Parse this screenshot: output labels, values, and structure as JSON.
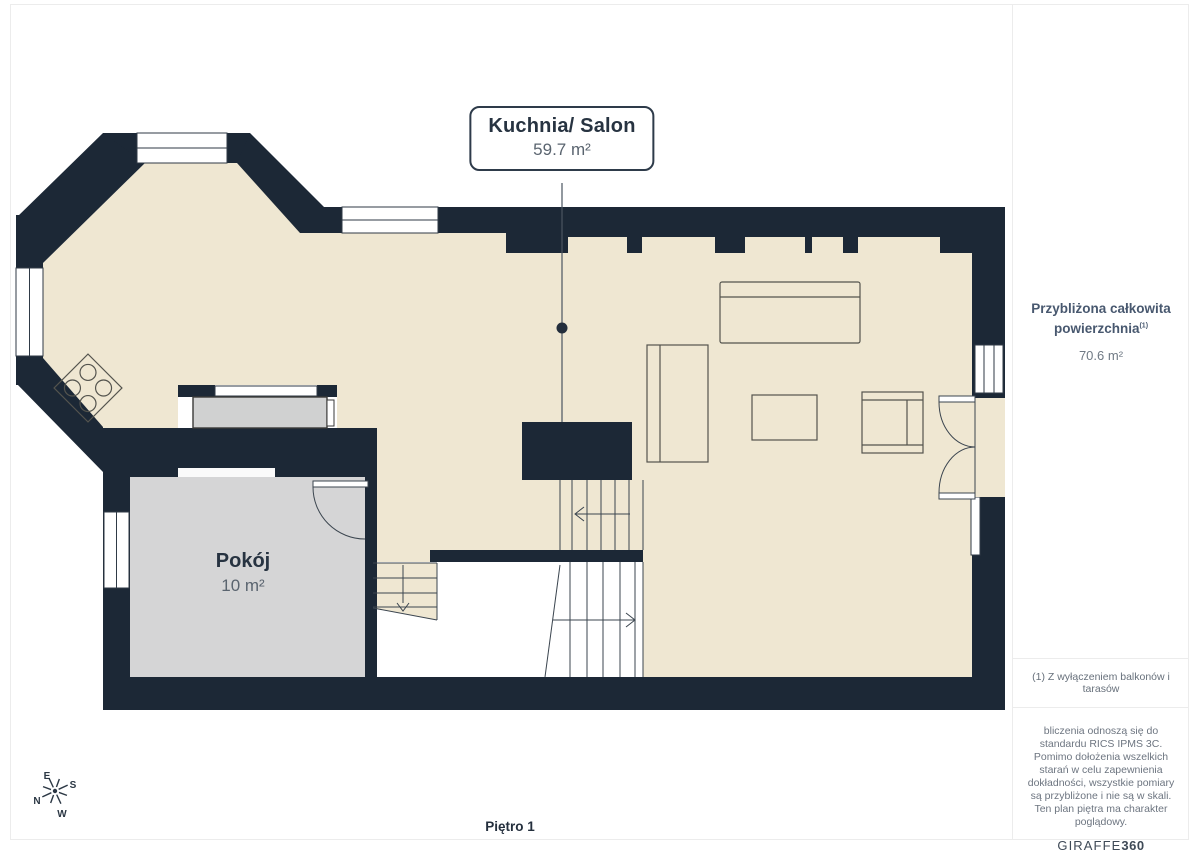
{
  "plan": {
    "floor_label": "Piętro 1",
    "rooms": [
      {
        "name": "Kuchnia/ Salon",
        "area": "59.7 m²"
      },
      {
        "name": "Pokój",
        "area": "10 m²"
      }
    ]
  },
  "sidebar": {
    "total_area_title": "Przybliżona całkowita powierzchnia",
    "total_area_footnote_ref": "(1)",
    "total_area_value": "70.6 m²",
    "footnote": "(1) Z wyłączeniem balkonów i tarasów",
    "disclaimer": "bliczenia odnoszą się do standardu RICS IPMS 3C. Pomimo dołożenia wszelkich starań w celu zapewnienia dokładności, wszystkie pomiary są przybliżone i nie są w skali. Ten plan piętra ma charakter poglądowy.",
    "logo_primary": "GIRAFFE",
    "logo_secondary": "360"
  },
  "compass": {
    "north": "N",
    "east": "E",
    "south": "S",
    "west": "W"
  },
  "colors": {
    "wall": "#1c2836",
    "floor": "#efe7d2",
    "room_gray": "#d5d5d6",
    "counter_gray": "#d0d1d1",
    "accent_text": "#273341",
    "muted_text": "#5a646f",
    "border": "#ececec"
  }
}
